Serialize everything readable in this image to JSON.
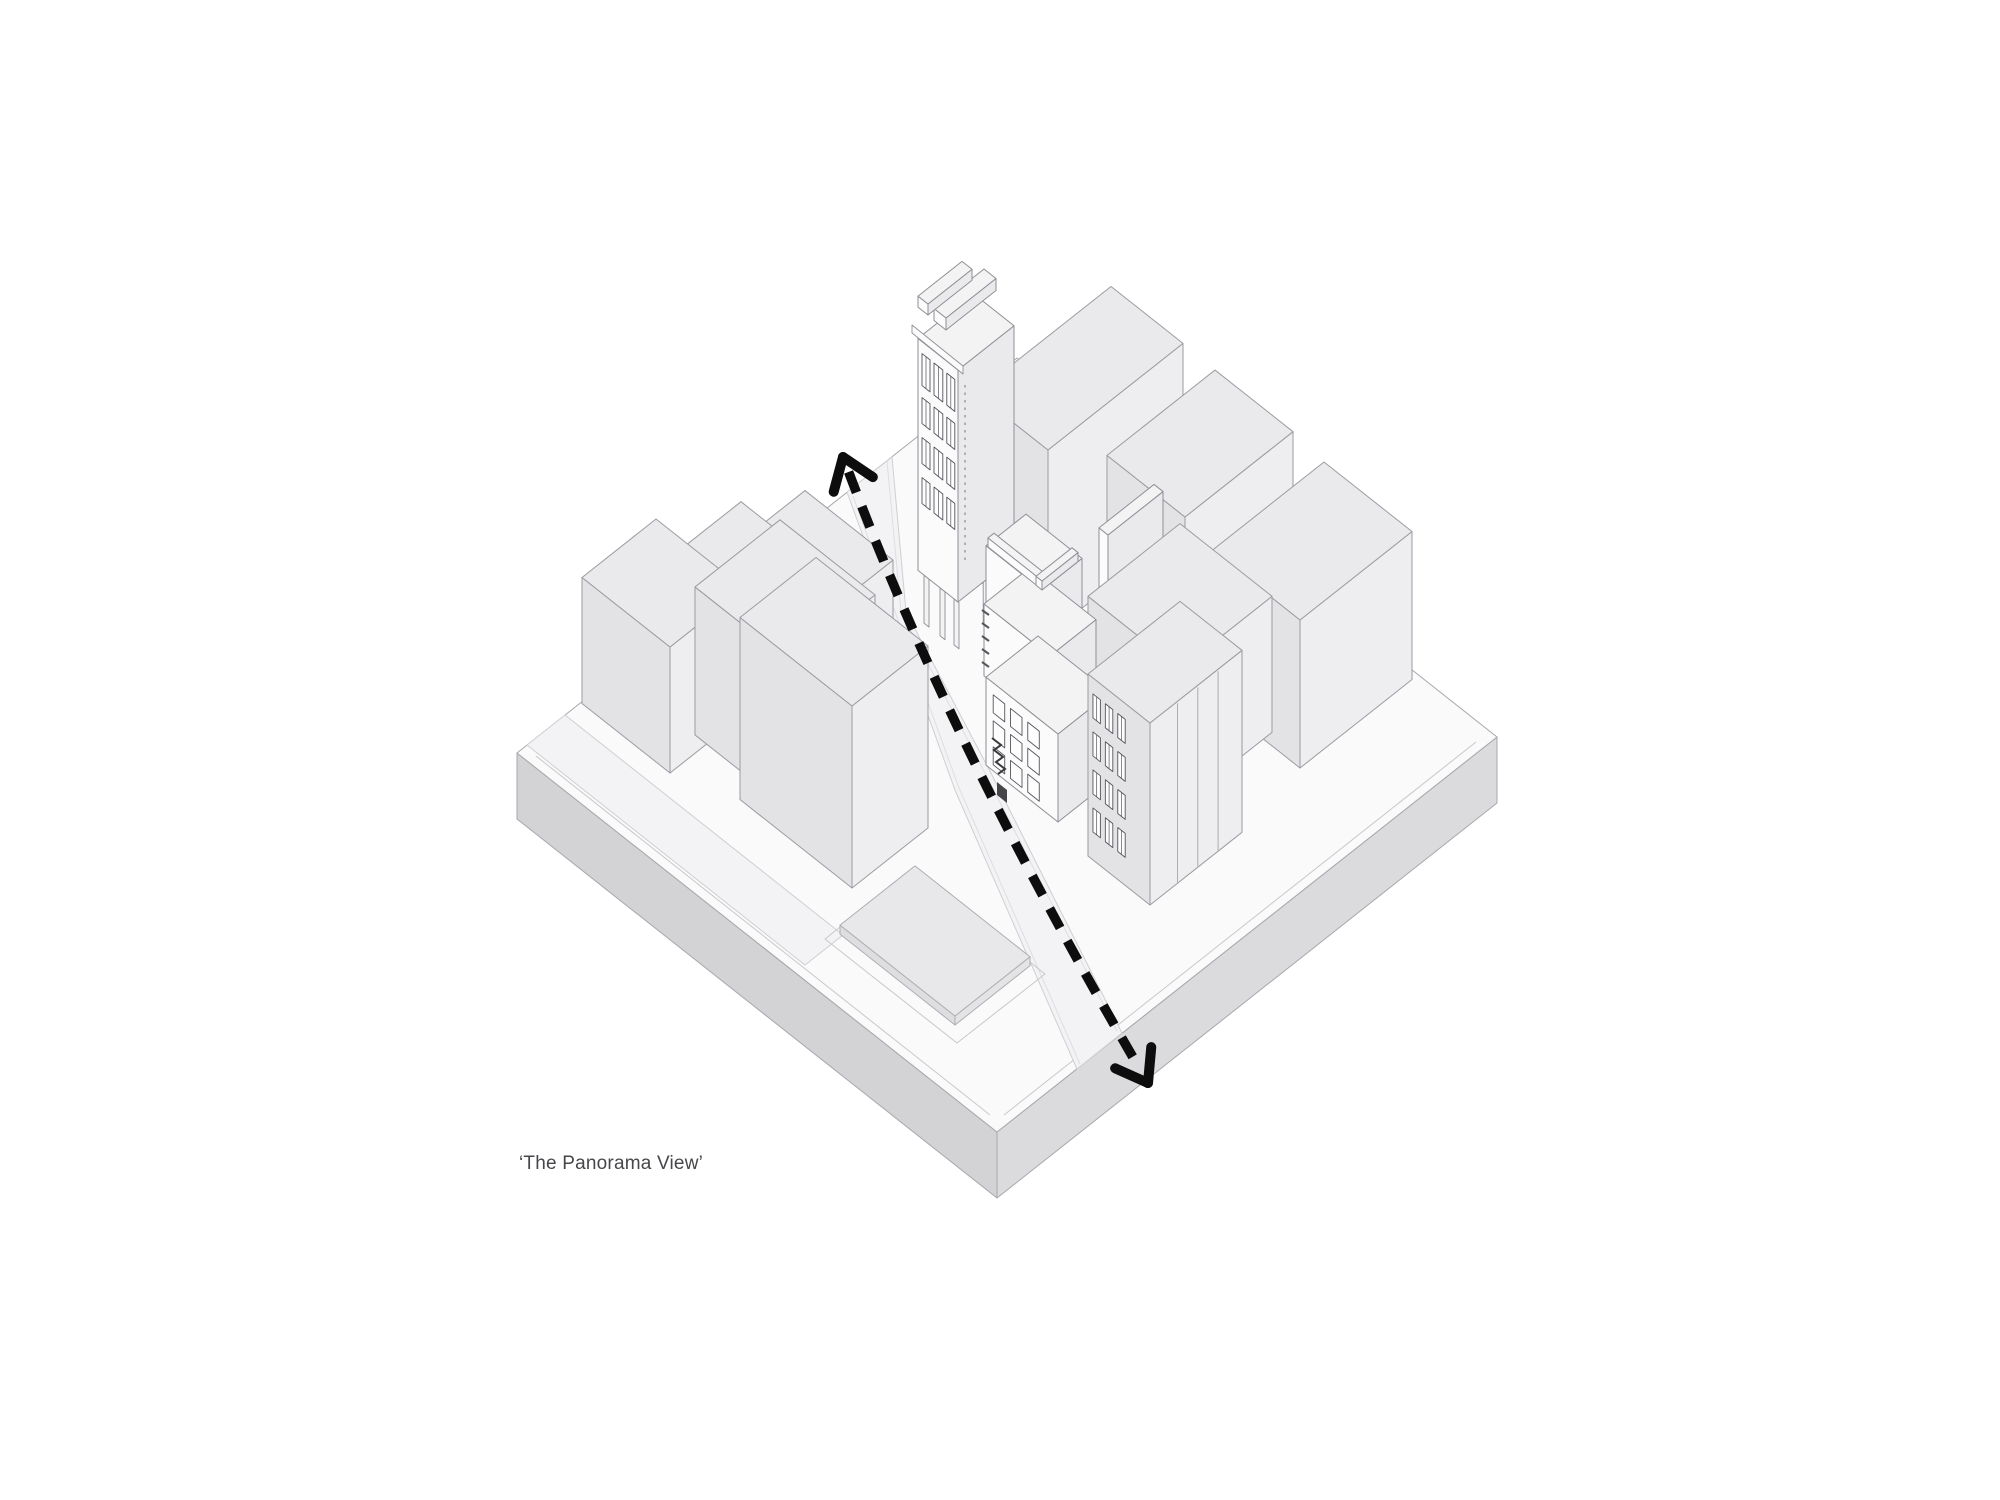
{
  "caption": {
    "text": "‘The Panorama View’"
  },
  "colors": {
    "background": "#ffffff",
    "arrow": "#0d0d0e",
    "plinth_top": "#fafafb",
    "plinth_sw_side": "#d3d3d6",
    "plinth_se_side": "#dbdbde",
    "plinth_edge": "#a7a7ac",
    "street_fill": "#f3f3f5",
    "street_edge": "#cfcfd3",
    "curb_inner": "#dedee1",
    "pad_ring": "#c8c8cc",
    "palette_std": {
      "top": "#eaeaec",
      "sw": "#e3e3e6",
      "se": "#eeeef0",
      "line": "#9b9ba1"
    },
    "palette_white": {
      "top": "#f3f3f4",
      "sw": "#fbfbfc",
      "se": "#eaeaed",
      "line": "#8f8f96"
    },
    "palette_pad": {
      "top": "#e8e8ea",
      "sw": "#dedee1",
      "se": "#e4e4e7",
      "line": "#aeaeb3"
    },
    "window_fill": "#fdfdfe",
    "window_line": "#55555c",
    "detail_dark": "#46464a"
  },
  "arrow": {
    "name": "panorama-view-direction",
    "p0": [
      843,
      457
    ],
    "ctrl": [
      952,
      748
    ],
    "p2": [
      1148,
      1083
    ],
    "trim": 16,
    "width": 9.5,
    "dash": "22 15",
    "head_length": 36,
    "head_spread": 0.62,
    "head_width": 10
  },
  "scene": {
    "projection": {
      "slope": 0.79
    },
    "plinth": {
      "top": [
        [
          517,
          753
        ],
        [
          997,
          1132
        ],
        [
          1497,
          737
        ],
        [
          1017,
          358
        ]
      ],
      "sw_side": [
        [
          517,
          753
        ],
        [
          997,
          1132
        ],
        [
          997,
          1198
        ],
        [
          517,
          819
        ]
      ],
      "se_side": [
        [
          997,
          1132
        ],
        [
          1497,
          737
        ],
        [
          1497,
          803
        ],
        [
          997,
          1198
        ]
      ],
      "insets": [
        [
          [
            536,
            756
          ],
          [
            990,
            1115
          ]
        ],
        [
          [
            1004,
            1115
          ],
          [
            1476,
            742
          ]
        ]
      ]
    },
    "streets": {
      "main": [
        [
          847,
          492
        ],
        [
          955,
          790
        ],
        [
          1077,
          1069
        ],
        [
          1122,
          1033
        ],
        [
          992,
          775
        ],
        [
          906,
          612
        ],
        [
          892,
          457
        ]
      ],
      "curbs": [
        [
          [
            853,
            496
          ],
          [
            959,
            788
          ],
          [
            1080,
            1064
          ]
        ],
        [
          [
            887,
            461
          ],
          [
            901,
            612
          ],
          [
            987,
            777
          ],
          [
            1117,
            1031
          ]
        ]
      ],
      "side": [
        [
          527,
          745
        ],
        [
          805,
          965
        ],
        [
          843,
          935
        ],
        [
          565,
          715
        ]
      ]
    },
    "plaza": {
      "ring": [
        [
          957,
          1043
        ],
        [
          825,
          939
        ],
        [
          913,
          869
        ],
        [
          1045,
          974
        ]
      ],
      "pad": {
        "F": [
          955,
          1025
        ],
        "wL": 115,
        "wR": 75,
        "h": 9
      }
    },
    "boxes": [
      {
        "id": "slab-behind-tower",
        "F": [
          1048,
          635
        ],
        "wL": 72,
        "wR": 135,
        "h": 185,
        "z": 640,
        "pal": "std"
      },
      {
        "id": "left-upper-slab",
        "F": [
          845,
          662
        ],
        "wL": 88,
        "wR": 48,
        "h": 64,
        "z": 648,
        "pal": "std"
      },
      {
        "id": "right-notched-slab",
        "F": [
          1185,
          655
        ],
        "wL": 78,
        "wR": 108,
        "h": 138,
        "z": 655,
        "pal": "std"
      },
      {
        "id": "tower",
        "F": [
          958,
          602
        ],
        "wL": 40,
        "wR": 56,
        "h": 232,
        "z": 656,
        "pal": "white",
        "columns": [
          {
            "edge": "LF",
            "t": 0.15,
            "w": 5,
            "drop": 48
          },
          {
            "edge": "LF",
            "t": 0.55,
            "w": 5,
            "drop": 48
          },
          {
            "edge": "LF",
            "t": 0.9,
            "w": 5,
            "drop": 46
          },
          {
            "edge": "FR",
            "t": 0.45,
            "w": 5,
            "drop": 42
          }
        ],
        "swWindows": {
          "rows": [
            [
              12,
              44
            ],
            [
              56,
              82
            ],
            [
              96,
              122
            ],
            [
              136,
              162
            ]
          ],
          "cols": [
            [
              0.1,
              0.3
            ],
            [
              0.4,
              0.62
            ],
            [
              0.72,
              0.92
            ]
          ],
          "mullion": true
        }
      },
      {
        "id": "tower-roof-strip-1",
        "F": [
          946,
          330
        ],
        "wL": 12,
        "wR": 50,
        "h": 12,
        "z": 657,
        "pal": "white"
      },
      {
        "id": "tower-roof-strip-2",
        "F": [
          928,
          315
        ],
        "wL": 10,
        "wR": 44,
        "h": 11,
        "z": 658,
        "pal": "white"
      },
      {
        "id": "left-back-slab",
        "F": [
          755,
          722
        ],
        "wL": 92,
        "wR": 78,
        "h": 86,
        "z": 672,
        "pal": "std"
      },
      {
        "id": "central-party-wall",
        "F": [
          1108,
          700
        ],
        "wL": 9,
        "wR": 55,
        "h": 165,
        "z": 700,
        "pal": "white"
      },
      {
        "id": "left-west-box",
        "F": [
          670,
          773
        ],
        "wL": 88,
        "wR": 74,
        "h": 126,
        "z": 701,
        "pal": "std"
      },
      {
        "id": "right-far-box",
        "F": [
          1300,
          768
        ],
        "wL": 88,
        "wR": 112,
        "h": 148,
        "z": 768,
        "pal": "std"
      },
      {
        "id": "left-mid-box",
        "F": [
          790,
          810
        ],
        "wL": 95,
        "wR": 85,
        "h": 148,
        "z": 800,
        "pal": "std"
      },
      {
        "id": "right-mid-box",
        "F": [
          1180,
          805
        ],
        "wL": 92,
        "wR": 92,
        "h": 136,
        "z": 802,
        "pal": "std"
      },
      {
        "id": "central-upper-terrace",
        "F": [
          1042,
          650
        ],
        "wL": 56,
        "wR": 40,
        "h": 60,
        "z": 828,
        "pal": "white"
      },
      {
        "id": "central-mid-volume",
        "F": [
          1050,
          728
        ],
        "wL": 66,
        "wR": 46,
        "h": 72,
        "z": 829,
        "pal": "white"
      },
      {
        "id": "central-base-volume",
        "F": [
          1058,
          822
        ],
        "wL": 72,
        "wR": 52,
        "h": 88,
        "z": 830,
        "pal": "white",
        "swWindows": {
          "rows": [
            [
              12,
              30
            ],
            [
              38,
              56
            ],
            [
              64,
              82
            ]
          ],
          "cols": [
            [
              0.1,
              0.26
            ],
            [
              0.34,
              0.5
            ],
            [
              0.58,
              0.74
            ]
          ],
          "mullion": false
        }
      },
      {
        "id": "central-parapet-left",
        "F": [
          1040,
          588
        ],
        "wL": 52,
        "wR": 6,
        "h": 9,
        "z": 833,
        "pal": "white"
      },
      {
        "id": "central-parapet-right",
        "F": [
          1042,
          590
        ],
        "wL": 6,
        "wR": 36,
        "h": 9,
        "z": 834,
        "pal": "white"
      },
      {
        "id": "left-front-tower",
        "F": [
          852,
          888
        ],
        "wL": 112,
        "wR": 76,
        "h": 182,
        "z": 878,
        "pal": "std"
      },
      {
        "id": "right-front-building",
        "F": [
          1150,
          905
        ],
        "wL": 62,
        "wR": 92,
        "h": 182,
        "z": 905,
        "pal": "std",
        "seLines": [
          0.3,
          0.52,
          0.74
        ],
        "swWindows": {
          "rows": [
            [
              16,
              40
            ],
            [
              54,
              78
            ],
            [
              92,
              116
            ],
            [
              130,
              154
            ]
          ],
          "cols": [
            [
              0.08,
              0.2
            ],
            [
              0.28,
              0.4
            ],
            [
              0.48,
              0.6
            ]
          ],
          "mullion": true
        }
      }
    ],
    "details": {
      "eave": [
        [
          912,
          333
        ],
        [
          963,
          374
        ],
        [
          963,
          366
        ],
        [
          912,
          325
        ]
      ],
      "dot_strip": [
        [
          965,
          385
        ],
        [
          965,
          560
        ]
      ],
      "balcony_ticks": {
        "start": [
          982,
          610
        ],
        "step": [
          0,
          13
        ],
        "delta": [
          7,
          5
        ],
        "count": 5
      },
      "stair_path": "M992,738 l9,7 l-7,5 l9,7 l-7,5 l9,7 l-7,5",
      "stair_patch": [
        [
          997,
          782
        ],
        [
          1007,
          790
        ],
        [
          1007,
          803
        ],
        [
          997,
          795
        ]
      ]
    }
  }
}
